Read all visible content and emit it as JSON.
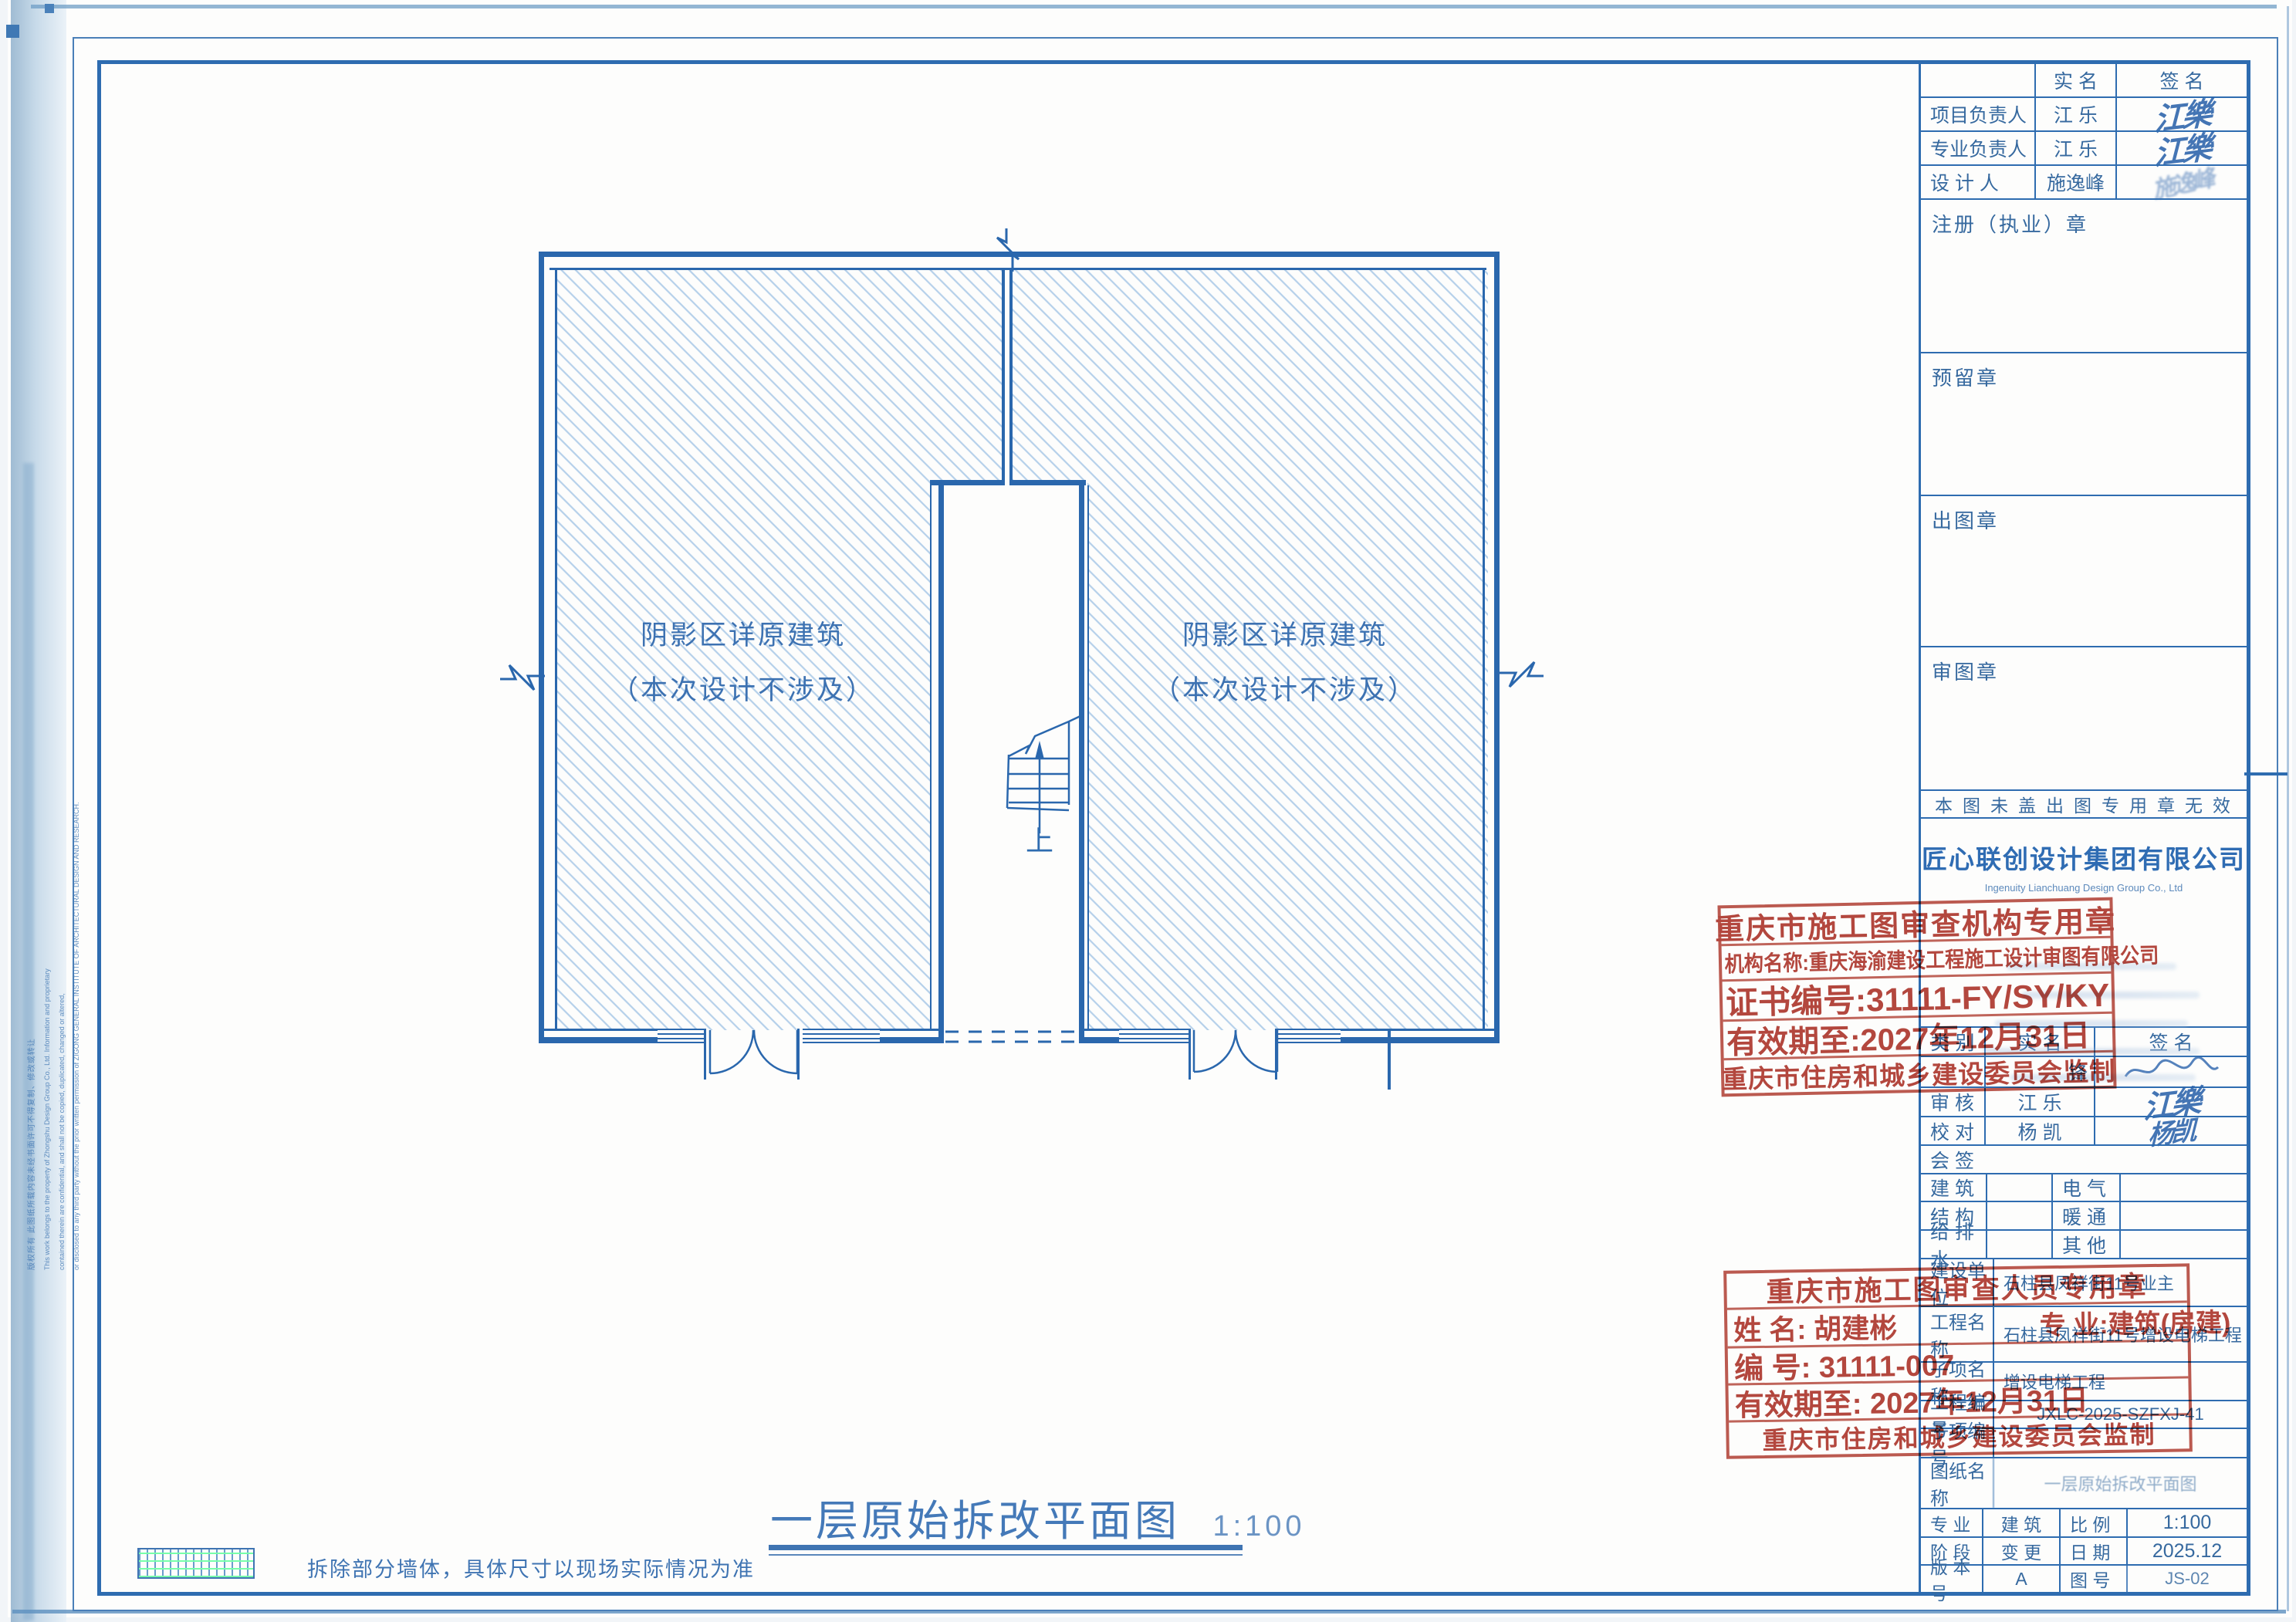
{
  "plan": {
    "region_note_line1": "阴影区详原建筑",
    "region_note_line2": "（本次设计不涉及）",
    "stair_up": "上",
    "title": "一层原始拆改平面图",
    "scale": "1:100",
    "legend_note": "拆除部分墙体，具体尺寸以现场实际情况为准"
  },
  "margin_note": {
    "cn": "版权所有 此图纸所载内容未经书面许可不得复制、修改或转让",
    "en1": "This work belongs to the property of Zhongshu Design Group Co., Ltd. Information and proprietary",
    "en2": "contained therein are confidential, and shall not be copied, duplicated, changed or altered,",
    "en3": "or disclosed to any third party without the prior written permission of ZIGONG GENERAL INSTITUTE OF ARCHITECTURAL DESIGN AND RESEARCH."
  },
  "titleblock": {
    "sign": {
      "name_header": "实  名",
      "sig_header": "签  名",
      "rows": [
        {
          "label": "项目负责人",
          "name": "江  乐",
          "sig": "江樂"
        },
        {
          "label": "专业负责人",
          "name": "江  乐",
          "sig": "江樂"
        },
        {
          "label": "设  计  人",
          "name": "施逸峰",
          "sig": "施逸峰"
        }
      ]
    },
    "seals": {
      "registration": "注册（执业）章",
      "reserved": "预留章",
      "issue": "出图章",
      "review": "审图章"
    },
    "notice": "本图未盖出图专用章无效",
    "company_cn": "匠心联创设计集团有限公司",
    "company_en": "Ingenuity Lianchuang Design Group Co., Ltd",
    "review": {
      "cat_header": "类  别",
      "name_header": "实  名",
      "sig_header": "签  名",
      "rows": [
        {
          "label": "",
          "name": "锋",
          "sig": ""
        },
        {
          "label": "审  核",
          "name": "江  乐",
          "sig": "江樂"
        },
        {
          "label": "校  对",
          "name": "杨  凯",
          "sig": "杨凯"
        }
      ],
      "joint": "会  签",
      "disciplines": [
        {
          "left": "建  筑",
          "right": "电  气"
        },
        {
          "left": "结  构",
          "right": "暖  通"
        },
        {
          "left": "给 排 水",
          "right": "其  他"
        }
      ]
    },
    "project": [
      {
        "label": "建设单位",
        "value": "石柱县凤祥街11号业主"
      },
      {
        "label": "工程名称",
        "value": "石柱县凤祥街11号增设电梯工程"
      },
      {
        "label": "子项名称",
        "value": "增设电梯工程"
      },
      {
        "label": "工程编号",
        "value": "JXLC-2025-SZFXJ-41"
      },
      {
        "label": "子项编号",
        "value": ""
      },
      {
        "label": "图纸名称",
        "value": "一层原始拆改平面图"
      }
    ],
    "spec": [
      {
        "label1": "专    业",
        "value1": "建    筑",
        "label2": "比    例",
        "value2": "1:100"
      },
      {
        "label1": "阶    段",
        "value1": "变    更",
        "label2": "日    期",
        "value2": "2025.12"
      },
      {
        "label1": "版 本 号",
        "value1": "A",
        "label2": "图    号",
        "value2": "JS-02"
      }
    ]
  },
  "stamps": {
    "agency": {
      "title": "重庆市施工图审查机构专用章",
      "org": "机构名称:重庆海渝建设工程施工设计审图有限公司",
      "cert": "证书编号:31111-FY/SY/KY",
      "valid": "有效期至:2027年12月31日",
      "footer": "重庆市住房和城乡建设委员会监制"
    },
    "person": {
      "title": "重庆市施工图审查人员专用章",
      "name": "姓 名: 胡建彬",
      "major": "专 业:建筑(房建)",
      "no": "编 号: 31111-007",
      "valid": "有效期至: 2027年12月31日",
      "footer": "重庆市住房和城乡建设委员会监制"
    }
  },
  "colors": {
    "line_blue": "#2e6cb0",
    "hatch_blue": "#b5d0ea",
    "stamp_red": "#b5473e"
  }
}
